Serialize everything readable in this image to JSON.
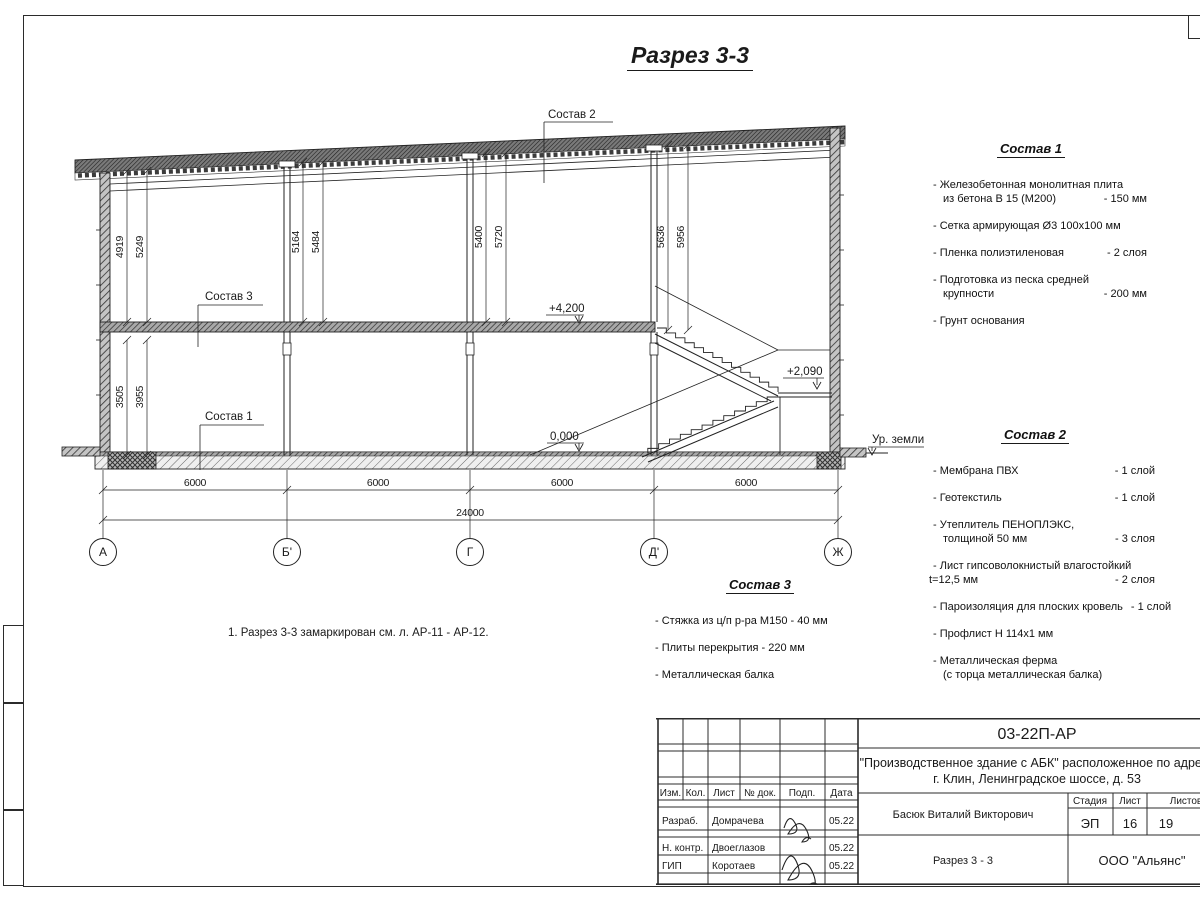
{
  "page": {
    "title": "Разрез 3-3",
    "note": "1. Разрез 3-3 замаркирован см. л. АР-11 - АР-12."
  },
  "drawing": {
    "axis_labels": {
      "a": "А",
      "b": "Б'",
      "g": "Г",
      "d": "Д'",
      "zh": "Ж"
    },
    "dims": {
      "bay1": "6000",
      "bay2": "6000",
      "bay3": "6000",
      "bay4": "6000",
      "total": "24000",
      "a_up_in": "4919",
      "a_up_out": "5249",
      "b_up_in": "5164",
      "b_up_out": "5484",
      "g_up_in": "5400",
      "g_up_out": "5720",
      "d_up_in": "5636",
      "d_up_out": "5956",
      "a_low_in": "3505",
      "a_low_out": "3955"
    },
    "elevations": {
      "floor2": "+4,200",
      "floor1": "0,000",
      "landing": "+2,090",
      "ground": "Ур. земли"
    },
    "leaders": {
      "s1": "Состав 1",
      "s2": "Состав 2",
      "s3": "Состав 3"
    }
  },
  "spec1": {
    "title": "Состав 1",
    "r0": {
      "t": "- Железобетонная  монолитная плита"
    },
    "r1": {
      "t": "из бетона В 15 (М200)",
      "v": "- 150 мм"
    },
    "r2": {
      "t": "- Сетка армирующая Ø3 100х100 мм"
    },
    "r3": {
      "t": "- Пленка полиэтиленовая",
      "v": "-  2 слоя"
    },
    "r4": {
      "t": "- Подготовка из песка средней"
    },
    "r5": {
      "t": "крупности",
      "v": "- 200 мм"
    },
    "r6": {
      "t": "- Грунт основания"
    }
  },
  "spec2": {
    "title": "Состав 2",
    "r0": {
      "t": "- Мембрана ПВХ",
      "v": "- 1 слой"
    },
    "r1": {
      "t": "- Геотекстиль",
      "v": "- 1 слой"
    },
    "r2": {
      "t": "- Утеплитель ПЕНОПЛЭКС,"
    },
    "r3": {
      "t": "толщиной 50 мм",
      "v": "- 3 слоя"
    },
    "r4": {
      "t": "- Лист гипсоволокнистый влагостойкий"
    },
    "r5": {
      "t": "t=12,5 мм",
      "v": "- 2 слоя"
    },
    "r6": {
      "t": "- Пароизоляция для плоских кровель",
      "v": "- 1 слой"
    },
    "r7": {
      "t": "- Профлист Н 114х1 мм"
    },
    "r8": {
      "t": "- Металлическая ферма"
    },
    "r9": {
      "t": "(с торца металлическая балка)"
    }
  },
  "spec3": {
    "title": "Состав 3",
    "r0": {
      "t": "- Стяжка из ц/п р-ра М150 - 40 мм"
    },
    "r1": {
      "t": "- Плиты перекрытия - 220 мм"
    },
    "r2": {
      "t": "- Металлическая балка"
    }
  },
  "title_block": {
    "doc_number": "03-22П-АР",
    "project_line1": "\"Производственное здание с АБК\" расположенное по адресу",
    "project_line2": "г. Клин, Ленинградское шоссе, д. 53",
    "approver": "Басюк Виталий Викторович",
    "sheet_name": "Разрез 3 - 3",
    "company": "ООО \"Альянс\"",
    "cols": {
      "izm": "Изм.",
      "kol": "Кол.",
      "list": "Лист",
      "doc": "№ док.",
      "podp": "Подп.",
      "data": "Дата"
    },
    "stage_label": "Стадия",
    "sheet_label": "Лист",
    "sheets_label": "Листов",
    "stage": "ЭП",
    "sheet_no": "16",
    "sheets_total": "19",
    "rows": {
      "r1": {
        "role": "Разраб.",
        "name": "Домрачева",
        "date": "05.22"
      },
      "r2": {
        "role": "Н. контр.",
        "name": "Двоеглазов",
        "date": "05.22"
      },
      "r3": {
        "role": "ГИП",
        "name": "Коротаев",
        "date": "05.22"
      }
    }
  }
}
